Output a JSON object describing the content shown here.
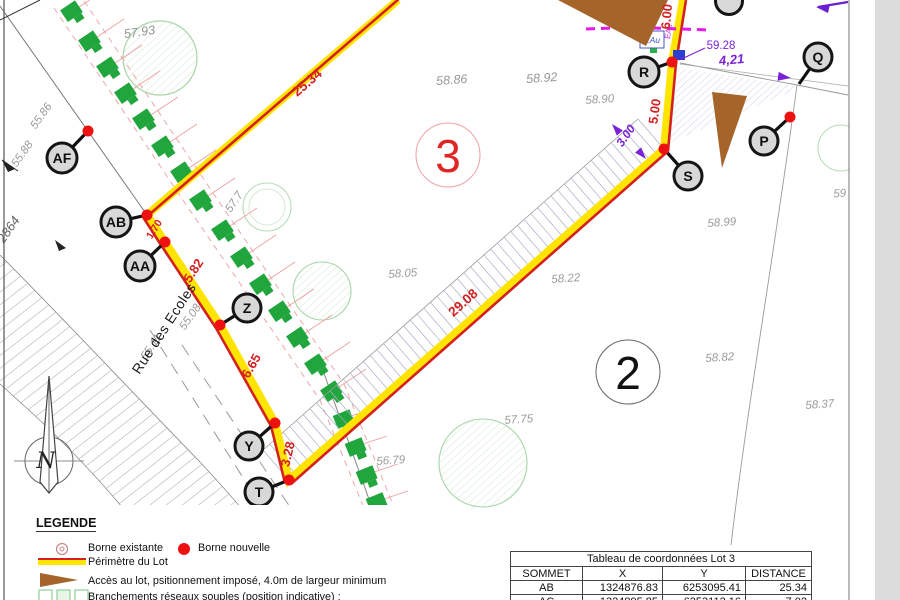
{
  "map": {
    "street_name": "Rue des Ecoles",
    "north_label": "N",
    "parcel_number": "2864",
    "lot_labels": {
      "lot3": "3",
      "lot2": "2"
    },
    "vertex_labels": {
      "af": "AF",
      "ab": "AB",
      "aa": "AA",
      "z": "Z",
      "y": "Y",
      "t": "T",
      "r": "R",
      "s": "S",
      "q": "Q",
      "p": "P"
    },
    "red_dimensions": {
      "ab_ac": "25.34",
      "ab_aa": "1.70",
      "aa_z": "5.82",
      "z_y": "6.65",
      "y_t": "3.28",
      "t_s": "29.08",
      "s_r": "5.00",
      "r_north": "6.00"
    },
    "purple_annotations": {
      "elevation": "59.28",
      "access_width": "4,21",
      "strip_width": "3.00",
      "network_eac": "EAc",
      "network_eau": "EAu"
    },
    "spot_heights": [
      "57.93",
      "55.86",
      "55.88",
      "58.86",
      "58.92",
      "58.90",
      "58.99",
      "59",
      "58.05",
      "58.22",
      "58.82",
      "58.37",
      "57.75",
      "56.79",
      "55.08",
      "55.11",
      "57.7"
    ]
  },
  "legend": {
    "title": "LEGENDE",
    "borne_existante": "Borne existante",
    "borne_nouvelle": "Borne nouvelle",
    "perimetre": "Périmètre du Lot",
    "acces": "Accès au lot, psitionnement imposé, 4.0m de largeur minimum",
    "branchements": "Branchements réseaux souples (position indicative) :"
  },
  "table": {
    "title": "Tableau de coordonnées Lot 3",
    "headers": [
      "SOMMET",
      "X",
      "Y",
      "DISTANCE"
    ],
    "rows": [
      [
        "AB",
        "1324876.83",
        "6253095.41",
        "25.34"
      ],
      [
        "AC",
        "1324895.85",
        "6253112.16",
        "7.02"
      ]
    ]
  },
  "palette": {
    "perimeter_yellow": "#ffe400",
    "perimeter_red": "#d42020",
    "borne_red": "#ee1111",
    "network_green": "#21a63e",
    "access_brown": "#a5652a",
    "annotation_purple": "#7b22d6",
    "network_magenta": "#e61ae6",
    "elevation_grey": "#9b9b9b"
  }
}
